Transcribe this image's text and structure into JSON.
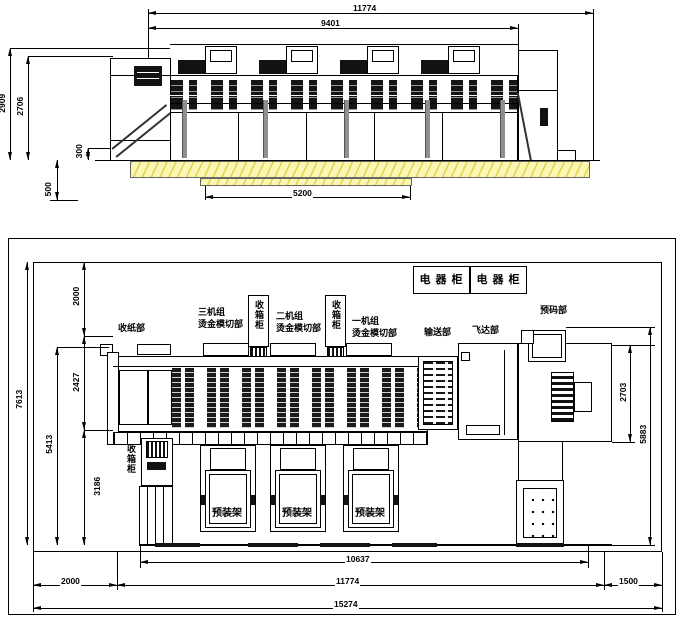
{
  "drawing": {
    "type": "machine layout engineering drawing, side elevation and plan view"
  },
  "colors": {
    "line": "#000000",
    "floor_fill": "#FBF6B4",
    "floor_hatch": "#E5D14C",
    "metal_gray": "#8F8F8F"
  },
  "elevation": {
    "dims": {
      "total_width": "11774",
      "upper_width": "9401",
      "height_total": "2909",
      "height_machine": "2706",
      "platform_height": "300",
      "pit_depth": "500",
      "pit_width": "5200"
    }
  },
  "plan": {
    "electrical_cabinet_label": "电 器 柜",
    "sections": {
      "delivery": "收纸部",
      "unit3_line1": "三机组",
      "unit3_line2": "烫金模切部",
      "unit2_line1": "二机组",
      "unit2_line2": "烫金模切部",
      "unit1_line1": "一机组",
      "unit1_line2": "烫金模切部",
      "conveyor": "输送部",
      "feeder": "飞达部",
      "precode": "预码部",
      "collect_cabinet": "收箱柜",
      "preload_rack": "预装架"
    },
    "dims": {
      "total_depth": "7613",
      "front_depth": "5413",
      "rear_clearance": "2000",
      "machine_depth": "2427",
      "rack_depth": "3186",
      "right_unit_depth": "2703",
      "right_depth": "5883",
      "base_length": "10637",
      "left_clearance": "2000",
      "machine_length": "11774",
      "right_clearance": "1500",
      "total_length": "15274"
    }
  }
}
